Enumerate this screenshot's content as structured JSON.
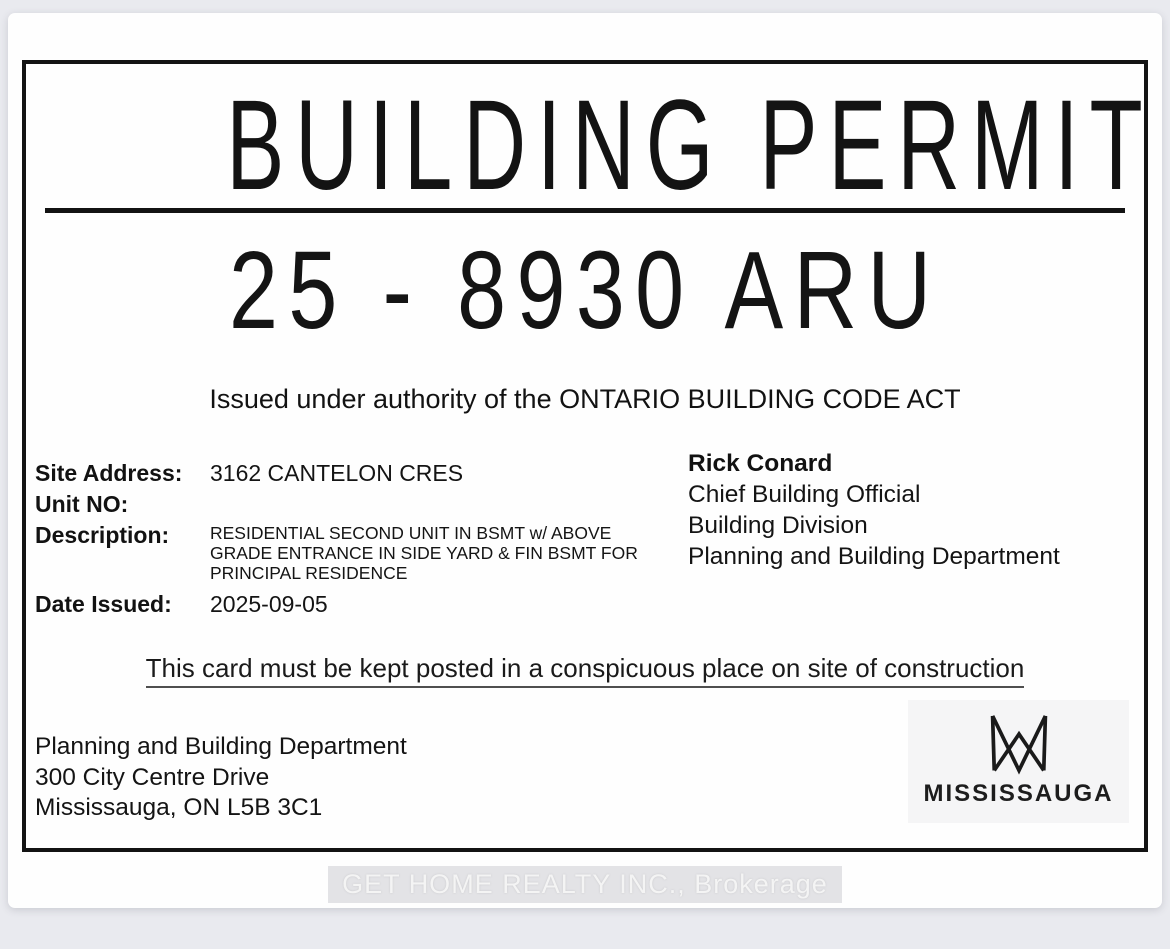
{
  "permit": {
    "title": "BUILDING PERMIT",
    "number": "25 - 8930 ARU",
    "authority_line": "Issued under authority of the ONTARIO BUILDING CODE ACT",
    "fields": {
      "site_address": {
        "label": "Site Address:",
        "value": "3162 CANTELON CRES"
      },
      "unit_no": {
        "label": "Unit NO:",
        "value": ""
      },
      "description": {
        "label": "Description:",
        "value": "RESIDENTIAL SECOND UNIT IN BSMT w/ ABOVE GRADE ENTRANCE IN SIDE YARD & FIN BSMT FOR PRINCIPAL RESIDENCE"
      },
      "date_issued": {
        "label": "Date Issued:",
        "value": "2025-09-05"
      }
    },
    "official": {
      "name": "Rick Conard",
      "title": "Chief Building Official",
      "division": "Building Division",
      "department": "Planning and Building Department"
    },
    "notice": "This card must be kept posted in a conspicuous place on site of construction",
    "issuer_address": {
      "line1": "Planning and Building Department",
      "line2": "300 City Centre Drive",
      "line3": "Mississauga, ON L5B 3C1"
    },
    "logo": {
      "icon": "mississauga-m-icon",
      "wordmark": "MISSISSAUGA"
    }
  },
  "watermark": {
    "text": "GET HOME REALTY INC., Brokerage"
  },
  "colors": {
    "ink": "#131313",
    "page": "#fefefe",
    "backdrop": "#e9eaef",
    "logo_panel": "#f5f5f6",
    "watermark_band": "#e3e3e6",
    "watermark_text": "#f4f4f4"
  }
}
